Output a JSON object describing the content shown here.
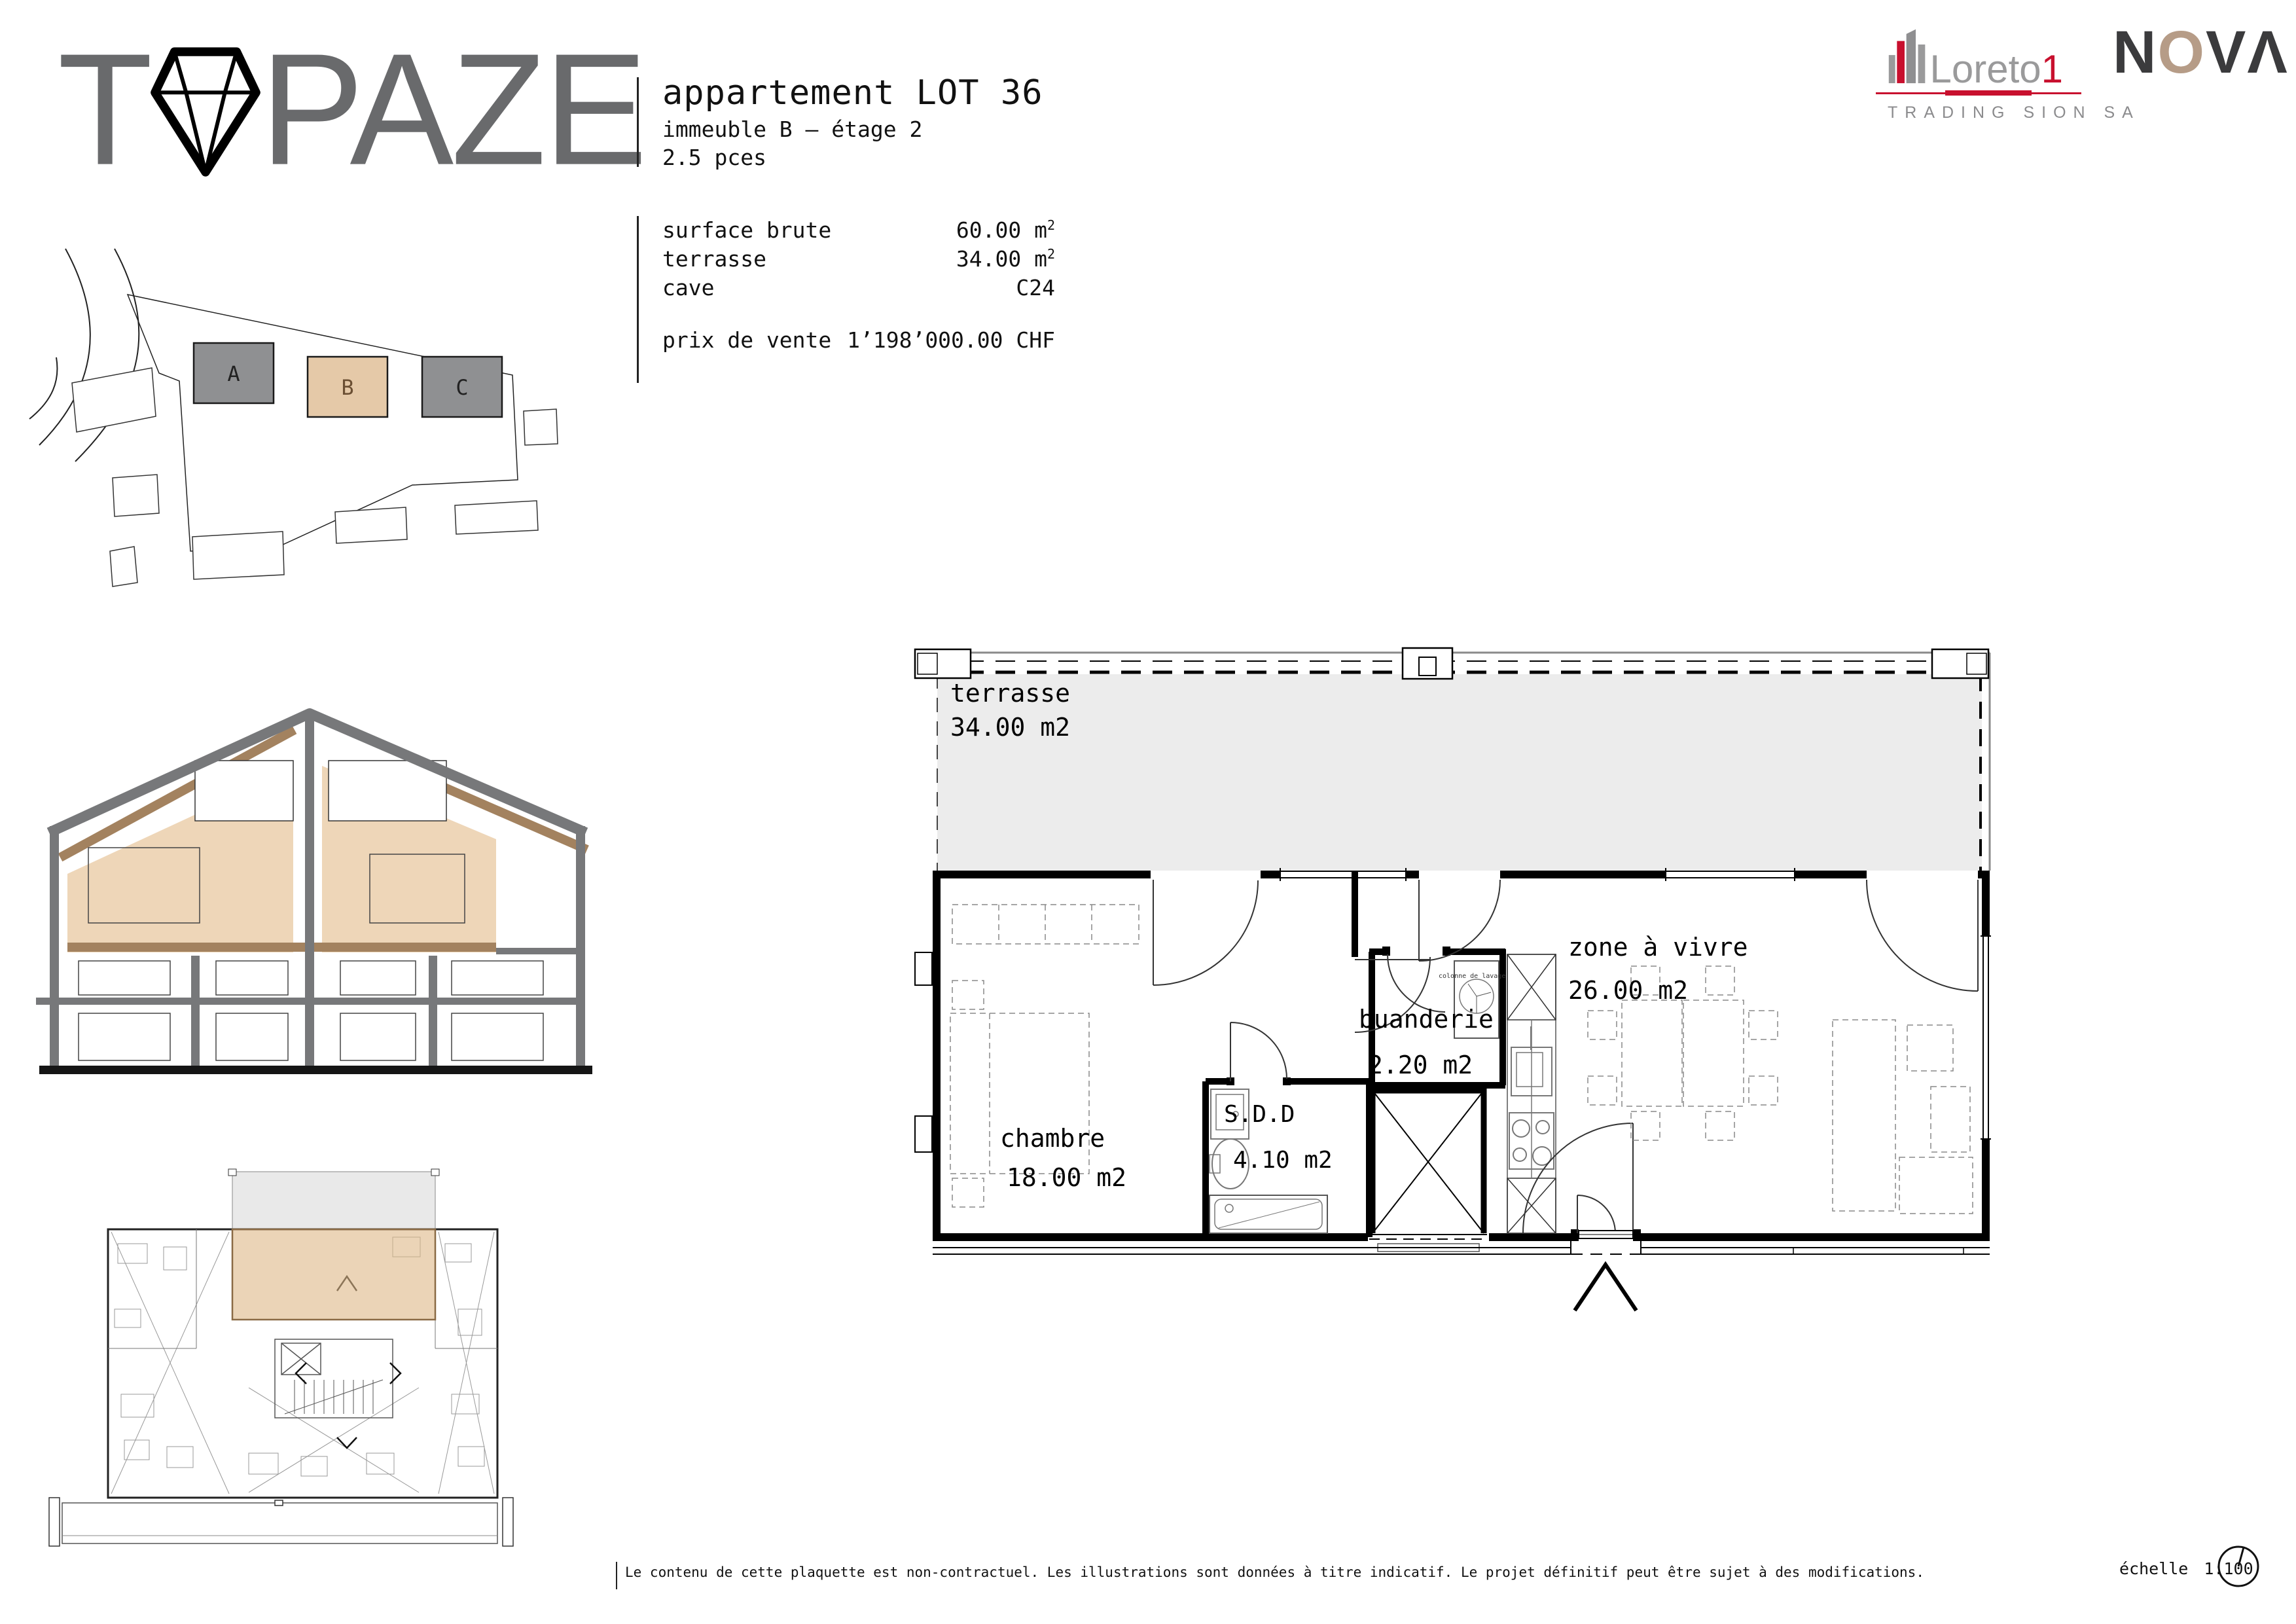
{
  "brand": {
    "t": "T",
    "paze": "PAZE"
  },
  "header": {
    "title": "appartement LOT 36",
    "subtitle": "immeuble B – étage 2",
    "pieces": "2.5 pces"
  },
  "specs": {
    "rows": [
      {
        "label": "surface brute",
        "value": "60.00 m",
        "sup": "2"
      },
      {
        "label": "terrasse",
        "value": "34.00 m",
        "sup": "2"
      },
      {
        "label": "cave",
        "value": "C24",
        "sup": ""
      }
    ],
    "price_label": "prix de vente",
    "price_value": "1’198’000.00 CHF"
  },
  "partners": {
    "loreto_name": "Loreto",
    "loreto_one": "1",
    "loreto_tagline": "TRADING SION SA",
    "nova_n": "N",
    "nova_o": "O",
    "nova_v": "V",
    "nova_a": "Λ"
  },
  "site_plan": {
    "building_a": "A",
    "building_b": "B",
    "building_c": "C"
  },
  "plan": {
    "terrace_name": "terrasse",
    "terrace_area": "34.00 m2",
    "chambre_name": "chambre",
    "chambre_area": "18.00 m2",
    "sdd_name": "S.D.D",
    "sdd_area": "4.10 m2",
    "buanderie_name": "buanderie",
    "buanderie_area": "2.20 m2",
    "zone_name": "zone à vivre",
    "zone_area": "26.00 m2",
    "washer_note": "colonne de lavage"
  },
  "footer": {
    "disclaimer": "Le contenu de cette plaquette est non-contractuel. Les illustrations sont données à titre indicatif. Le projet définitif peut être sujet à des modifications.",
    "scale_label": "échelle",
    "scale_value": "1:100"
  },
  "colors": {
    "highlight_tan": "#e5c9a8",
    "highlight_border": "#8a6a45",
    "section_beige": "#eed6b8",
    "section_brown": "#a3825f",
    "structure_gray": "#77787a",
    "terrace_gray": "#ececec",
    "logo_gray": "#696a6c",
    "loreto_red": "#c8102e",
    "loreto_gray": "#9a9a9b",
    "nova_dark": "#3b3b3d",
    "nova_tan": "#b69c87"
  }
}
